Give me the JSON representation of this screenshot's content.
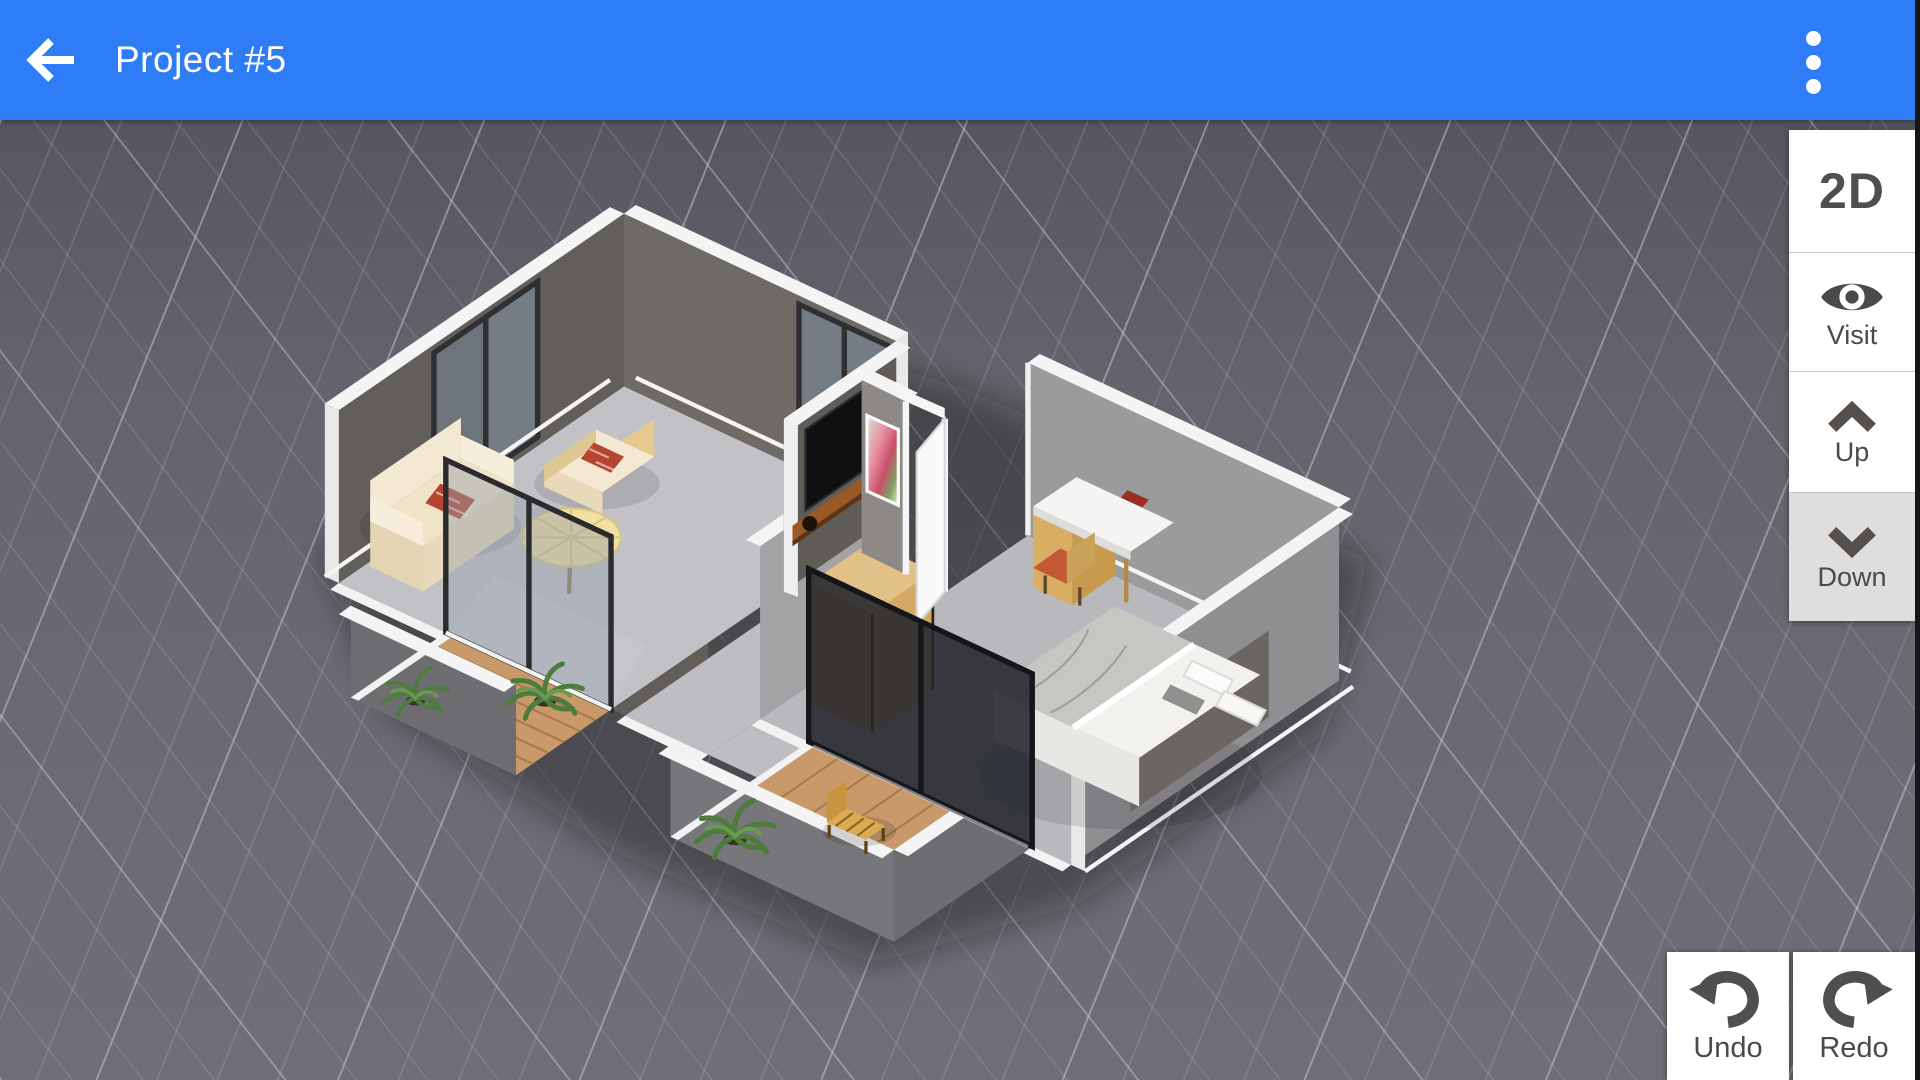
{
  "header": {
    "title": "Project #5"
  },
  "view_toolbar": {
    "mode_2d": "2D",
    "visit": "Visit",
    "up": "Up",
    "down": "Down",
    "active_button": "down"
  },
  "history_toolbar": {
    "undo": "Undo",
    "redo": "Redo"
  },
  "icons": {
    "back": "arrow-left-icon",
    "menu": "kebab-menu-icon",
    "visit": "eye-icon",
    "up": "chevron-up-icon",
    "down": "chevron-down-icon",
    "undo": "undo-arrow-icon",
    "redo": "redo-arrow-icon"
  },
  "colors": {
    "header_bg": "#2e7cf6",
    "canvas_bg": "#67676f",
    "grid_line": "#b9bdcc",
    "button_bg": "#ffffff",
    "button_active_bg": "#dedede",
    "button_text": "#4a4a4a"
  },
  "scene": {
    "type": "3d-floor-plan-view",
    "rooms": [
      "living-room",
      "hallway",
      "bedroom",
      "balcony-left",
      "balcony-right"
    ],
    "furniture": [
      "sofa",
      "armchair",
      "round-table",
      "tv",
      "tv-shelf",
      "wall-picture",
      "double-bed",
      "desk",
      "desk-chair",
      "wardrobe",
      "open-door",
      "outdoor-chair",
      "potted-plants",
      "sliding-glass-doors"
    ]
  }
}
